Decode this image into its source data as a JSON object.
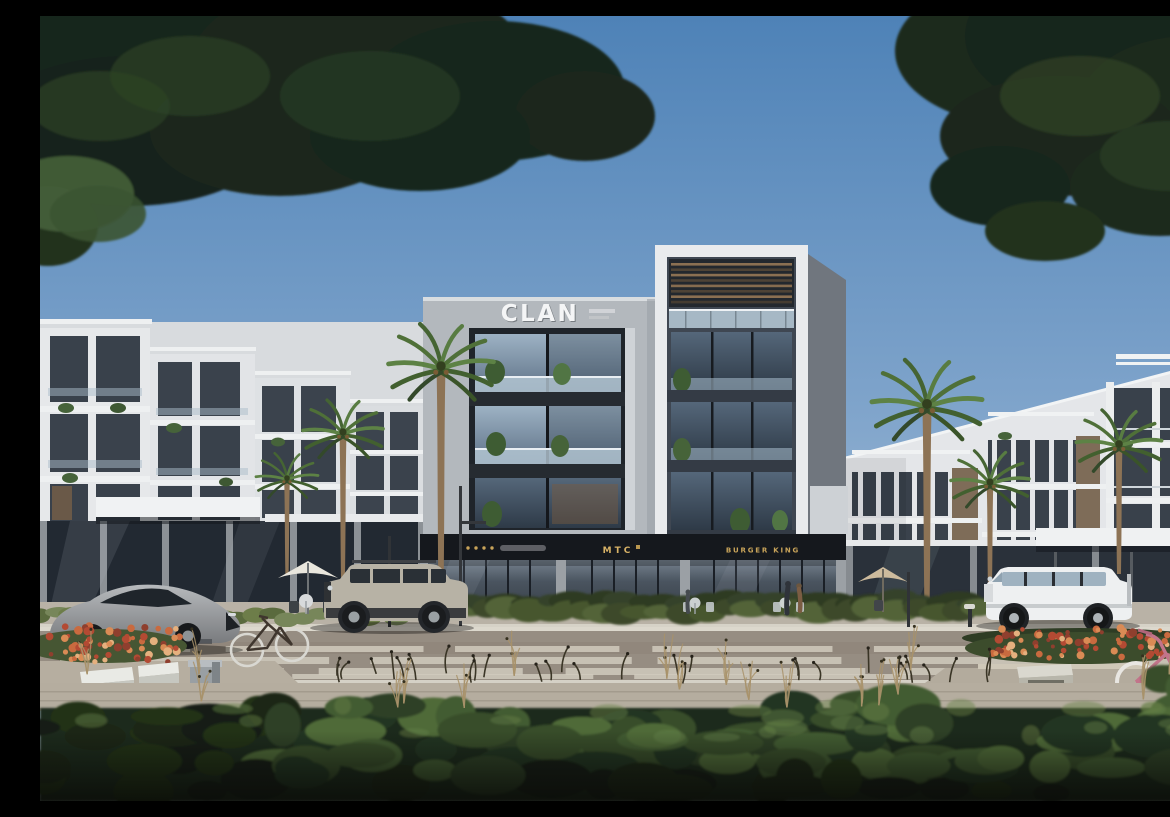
{
  "image": {
    "kind": "architectural exterior rendering",
    "description": "Street-level render of a modern residential block with ground-floor retail, flanked by white townhouse rows, palm trees, parked vehicles, bicycles, a zebra-striped road and overhanging trees framing a blue sky."
  },
  "signs": {
    "building_logo": "CLAN",
    "shop_center": "MTC",
    "shop_right": "BURGER KING"
  },
  "palette": {
    "sky_top": "#5585bb",
    "sky_horizon": "#b9cbdc",
    "facade_light_gray": "#b5bac0",
    "facade_white": "#e8eaec",
    "facade_dark_slate": "#3f4752",
    "storefront_band": "#15181d",
    "sign_gold": "#c9a45a",
    "glass_blue": "#8ea6ba",
    "palm_green": "#4f7038",
    "foliage_dark": "#19251a",
    "hedge_green": "#46562f",
    "flower_orange": "#c96a3f",
    "road_asphalt": "#968d82",
    "road_marking": "#d0cabd",
    "car_silver": "#9c9fa2",
    "suv_beige": "#b7b2a5",
    "suv_white": "#eef0f1",
    "bicycle_pink": "#c2748a"
  },
  "objects": [
    "overhanging-tree-left",
    "overhanging-tree-right",
    "clan-building",
    "rooftop-pergola",
    "left-townhouse-row",
    "right-townhouse-row",
    "palm-trees",
    "storefront-cafe",
    "storefront-mtc",
    "storefront-burger-king",
    "cafe-umbrellas",
    "pedestrians",
    "street-lamps",
    "sports-car",
    "boxy-suv",
    "g-class-suv",
    "city-bicycle",
    "pink-bicycle",
    "white-benches",
    "concrete-bench",
    "litter-bin",
    "flower-beds",
    "hedge",
    "zebra-crossing",
    "sidewalk",
    "foreground-shrubs",
    "ornamental-grasses"
  ]
}
